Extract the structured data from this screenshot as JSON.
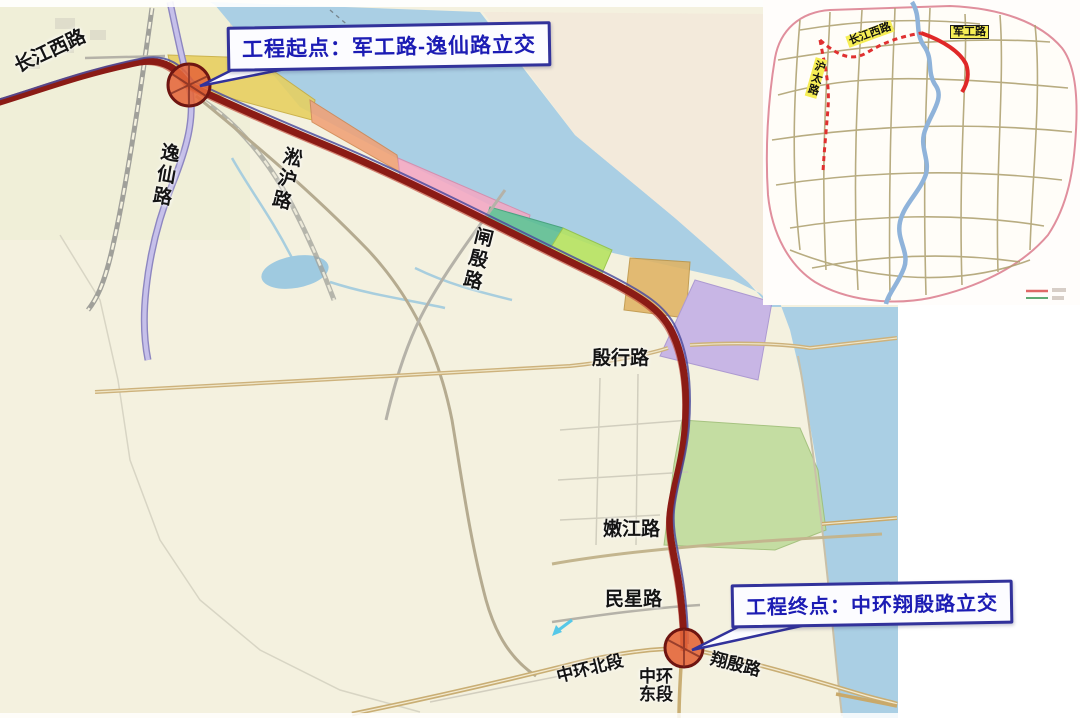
{
  "callouts": {
    "start": {
      "text": "工程起点：军工路-逸仙路立交"
    },
    "end": {
      "text": "工程终点：中环翔殷路立交"
    }
  },
  "main_map": {
    "road_labels": {
      "changjiangxi": "长江西路",
      "yixian": "逸仙路",
      "songhu": "淞沪路",
      "zhayin": "闸殷路",
      "yinhang": "殷行路",
      "nenjiang": "嫩江路",
      "minxing": "民星路",
      "zhonghuan_bei": "中环北段",
      "zhonghuan_dong": "中环东段",
      "xiangyin": "翔殷路"
    }
  },
  "inset_map": {
    "road_labels": {
      "changjiangxi": "长江西路",
      "jungong": "军工路",
      "hutai": "沪太路"
    },
    "legend": {
      "items": [
        {
          "swatch_color": "#e06868",
          "style": "solid-red-line"
        },
        {
          "swatch_color": "#4a9e62",
          "style": "solid-green-line"
        }
      ]
    }
  },
  "palette": {
    "land": "#f4f1df",
    "water": "#aacfe4",
    "far_shore": "#f2e9da",
    "route_main": "#8b1b15",
    "route_companion": "#4d4d9e",
    "interchange_fill": "#e4663a",
    "interchange_stroke": "#6e1511",
    "callout_border": "#32329b",
    "callout_text": "#1c1cb4",
    "zone_yellow": "#e7cf5e",
    "zone_salmon": "#f0a176",
    "zone_pink": "#f3a8c4",
    "zone_teal": "#5bbd92",
    "zone_lime": "#b5e35e",
    "zone_tan": "#e0b363",
    "zone_purple": "#c3afe6",
    "park_green": "#bedb9a",
    "inset_road": "#ac9f6d",
    "inset_river": "#8fb3da",
    "inset_route_red": "#e02828",
    "inset_boundary": "#e08f9d",
    "label_highlight": "#f6ee55"
  }
}
